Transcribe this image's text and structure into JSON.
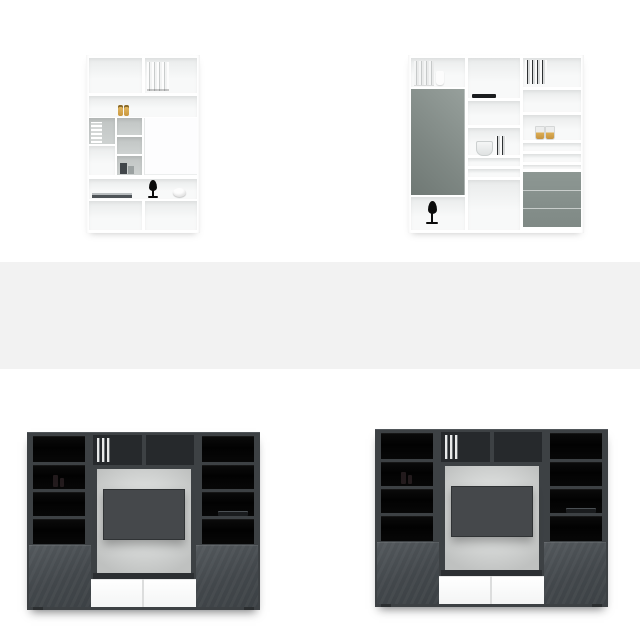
{
  "page": {
    "title": "Furniture product grid",
    "background": "#ffffff"
  },
  "grid": {
    "rows": 3,
    "cols": 2,
    "products": [
      {
        "id": "shelf-unit-white-tall",
        "position": "top-left",
        "alt": "Tall white shelving unit with open shelves, grey cube compartments, white door, binders, bottles, books, black drop sculpture and white bowl"
      },
      {
        "id": "wall-unit-white-grey",
        "position": "top-right",
        "alt": "White wall storage unit with tall grey-green door, open shelf columns with books, glass and cups, grey three-drawer cabinet and black drop sculpture"
      },
      {
        "id": "tv-wall-unit-dark",
        "position": "bottom-left",
        "alt": "Dark grey TV media wall with black display shelves, light back panel with mounted TV, two white drawers, grey lower doors and soundbar"
      },
      {
        "id": "tv-wall-unit-dark",
        "position": "bottom-right",
        "alt": "Dark grey TV media wall with black display shelves, light back panel with mounted TV, two white drawers, grey lower doors and soundbar"
      }
    ],
    "placeholder_row": {
      "present": true,
      "row": 2,
      "full_width": true
    }
  },
  "colors": {
    "page_bg": "#ffffff",
    "placeholder_band": "#f2f2f2",
    "cube_back_gray": "#c0c4c3",
    "sage_gray_door": "#6f7874",
    "sage_gray_cabinet": "#7f8985",
    "amber_bottle": "#c9973f",
    "accent_black": "#0b0b0b",
    "tv_frame_dark": "#3d4144",
    "black_glass": "#020202",
    "tv_screen": "#45484b",
    "panel_light": "#dadcdb",
    "drawer_white": "#f4f5f5",
    "lower_door_gray": "#42474b"
  }
}
